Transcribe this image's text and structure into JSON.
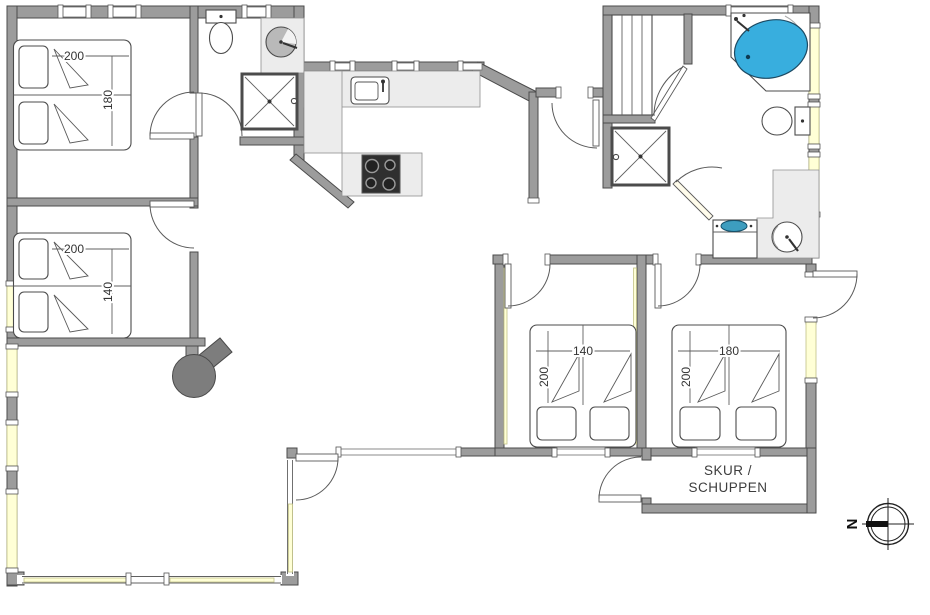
{
  "floorplan": {
    "type": "holiday-house-floor-plan",
    "beds": [
      {
        "name": "double-bed-top-left",
        "top_label": "200",
        "side_label": "180"
      },
      {
        "name": "double-bed-mid-left",
        "top_label": "200",
        "side_label": "140"
      },
      {
        "name": "double-bed-bottom-left",
        "top_label": "140",
        "side_label": "200"
      },
      {
        "name": "double-bed-bottom-right",
        "top_label": "180",
        "side_label": "200"
      }
    ],
    "shed": {
      "label_line_1": "SKUR /",
      "label_line_2": "SCHUPPEN"
    },
    "compass": {
      "north_abbreviation": "N"
    },
    "colors": {
      "wall_gray": "#9c9c9c",
      "wall_outline": "#4b4b4b",
      "window_glass_yellow": "#ffffd6",
      "bathtub_blue": "#38aede",
      "basin_blue": "#3d9dbf",
      "counter_gray": "#ececec",
      "range_dark": "#2f2f2f",
      "wood_stove_gray": "#7d7d7d"
    }
  }
}
